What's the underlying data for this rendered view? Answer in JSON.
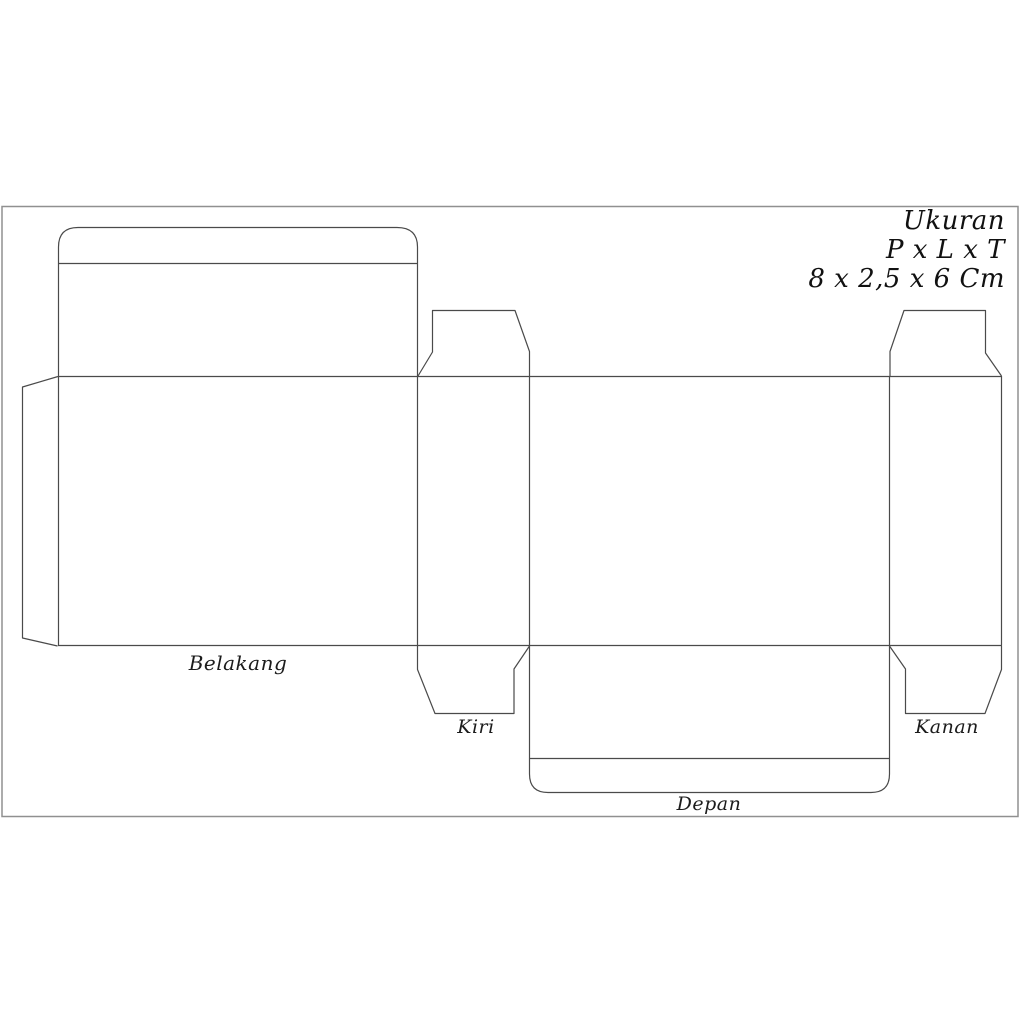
{
  "size_info": {
    "heading": "Ukuran",
    "formula": "P x L x T",
    "value": "8 x 2,5 x 6 Cm"
  },
  "panels": {
    "back": {
      "label": "Belakang"
    },
    "left": {
      "label": "Kiri"
    },
    "right": {
      "label": "Kanan"
    },
    "front": {
      "label": "Depan"
    }
  },
  "diagram": {
    "type": "box-dieline-template",
    "dimensions_cm": {
      "p": 8,
      "l": 2.5,
      "t": 6
    }
  },
  "colors": {
    "line": "#4a4a4a",
    "border": "#909090",
    "background": "#ffffff",
    "text": "#1c1c1c"
  }
}
